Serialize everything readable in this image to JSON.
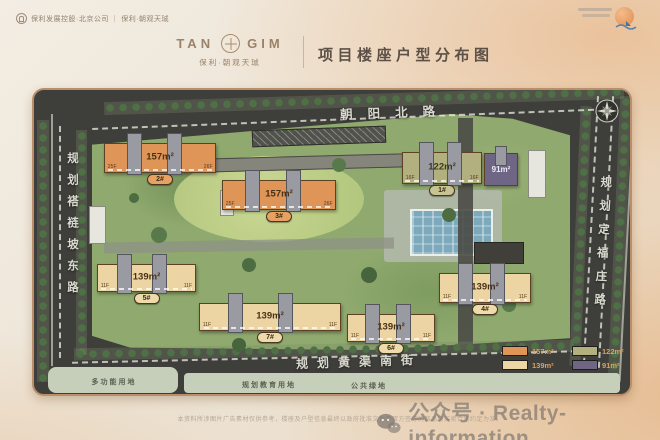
{
  "header": {
    "top_left": "保利发展控股·北京公司 ｜ 保利·朝观天珹",
    "brand": {
      "name_left": "TAN",
      "name_right": "GIM",
      "sub": "保利·朝观天珹"
    },
    "title": "项目楼座户型分布图"
  },
  "map": {
    "roads": {
      "north": "朝阳北路",
      "west": "规划褡裢坡东路",
      "east": "规划定福庄路",
      "south": "规划黄渠南街"
    },
    "land_labels": {
      "multi_use": "多功能用地",
      "education": "规划教育用地",
      "public_green": "公共绿地"
    },
    "buildings": {
      "b2": {
        "area": "157m²",
        "badge": "2#",
        "floor_l": "25F",
        "floor_r": "26F"
      },
      "b3": {
        "area": "157m²",
        "badge": "3#",
        "floor_l": "25F",
        "floor_r": "26F"
      },
      "b1": {
        "area": "122m²",
        "badge": "1#",
        "floor_l": "16F",
        "floor_r": "16F"
      },
      "b9": {
        "area": "91m²"
      },
      "b5": {
        "area": "139m²",
        "badge": "5#",
        "floor_l": "11F",
        "floor_r": "11F"
      },
      "b7": {
        "area": "139m²",
        "badge": "7#",
        "floor_l": "11F",
        "floor_r": "11F"
      },
      "b6": {
        "area": "139m²",
        "badge": "6#",
        "floor_l": "11F",
        "floor_r": "11F"
      },
      "b4": {
        "area": "139m²",
        "badge": "4#",
        "floor_l": "11F",
        "floor_r": "11F"
      }
    },
    "legend": {
      "items": [
        {
          "label": "157m²",
          "color": "#df9458"
        },
        {
          "label": "122m²",
          "color": "#b2b07e"
        },
        {
          "label": "139m²",
          "color": "#ecd5a3"
        },
        {
          "label": "91m²",
          "color": "#6e6684"
        }
      ]
    }
  },
  "colors": {
    "c157": "#df9458",
    "c139": "#ecd5a3",
    "c122": "#b2b07e",
    "c91": "#6e6684"
  },
  "footer": {
    "disclaimer": "本资料所涉图片广告素材仅供参考，楼座及户型信息最终以政府批准文件及双方签订的商品房买卖合同约定为准。",
    "watermark": "公众号 · Realty-information"
  }
}
